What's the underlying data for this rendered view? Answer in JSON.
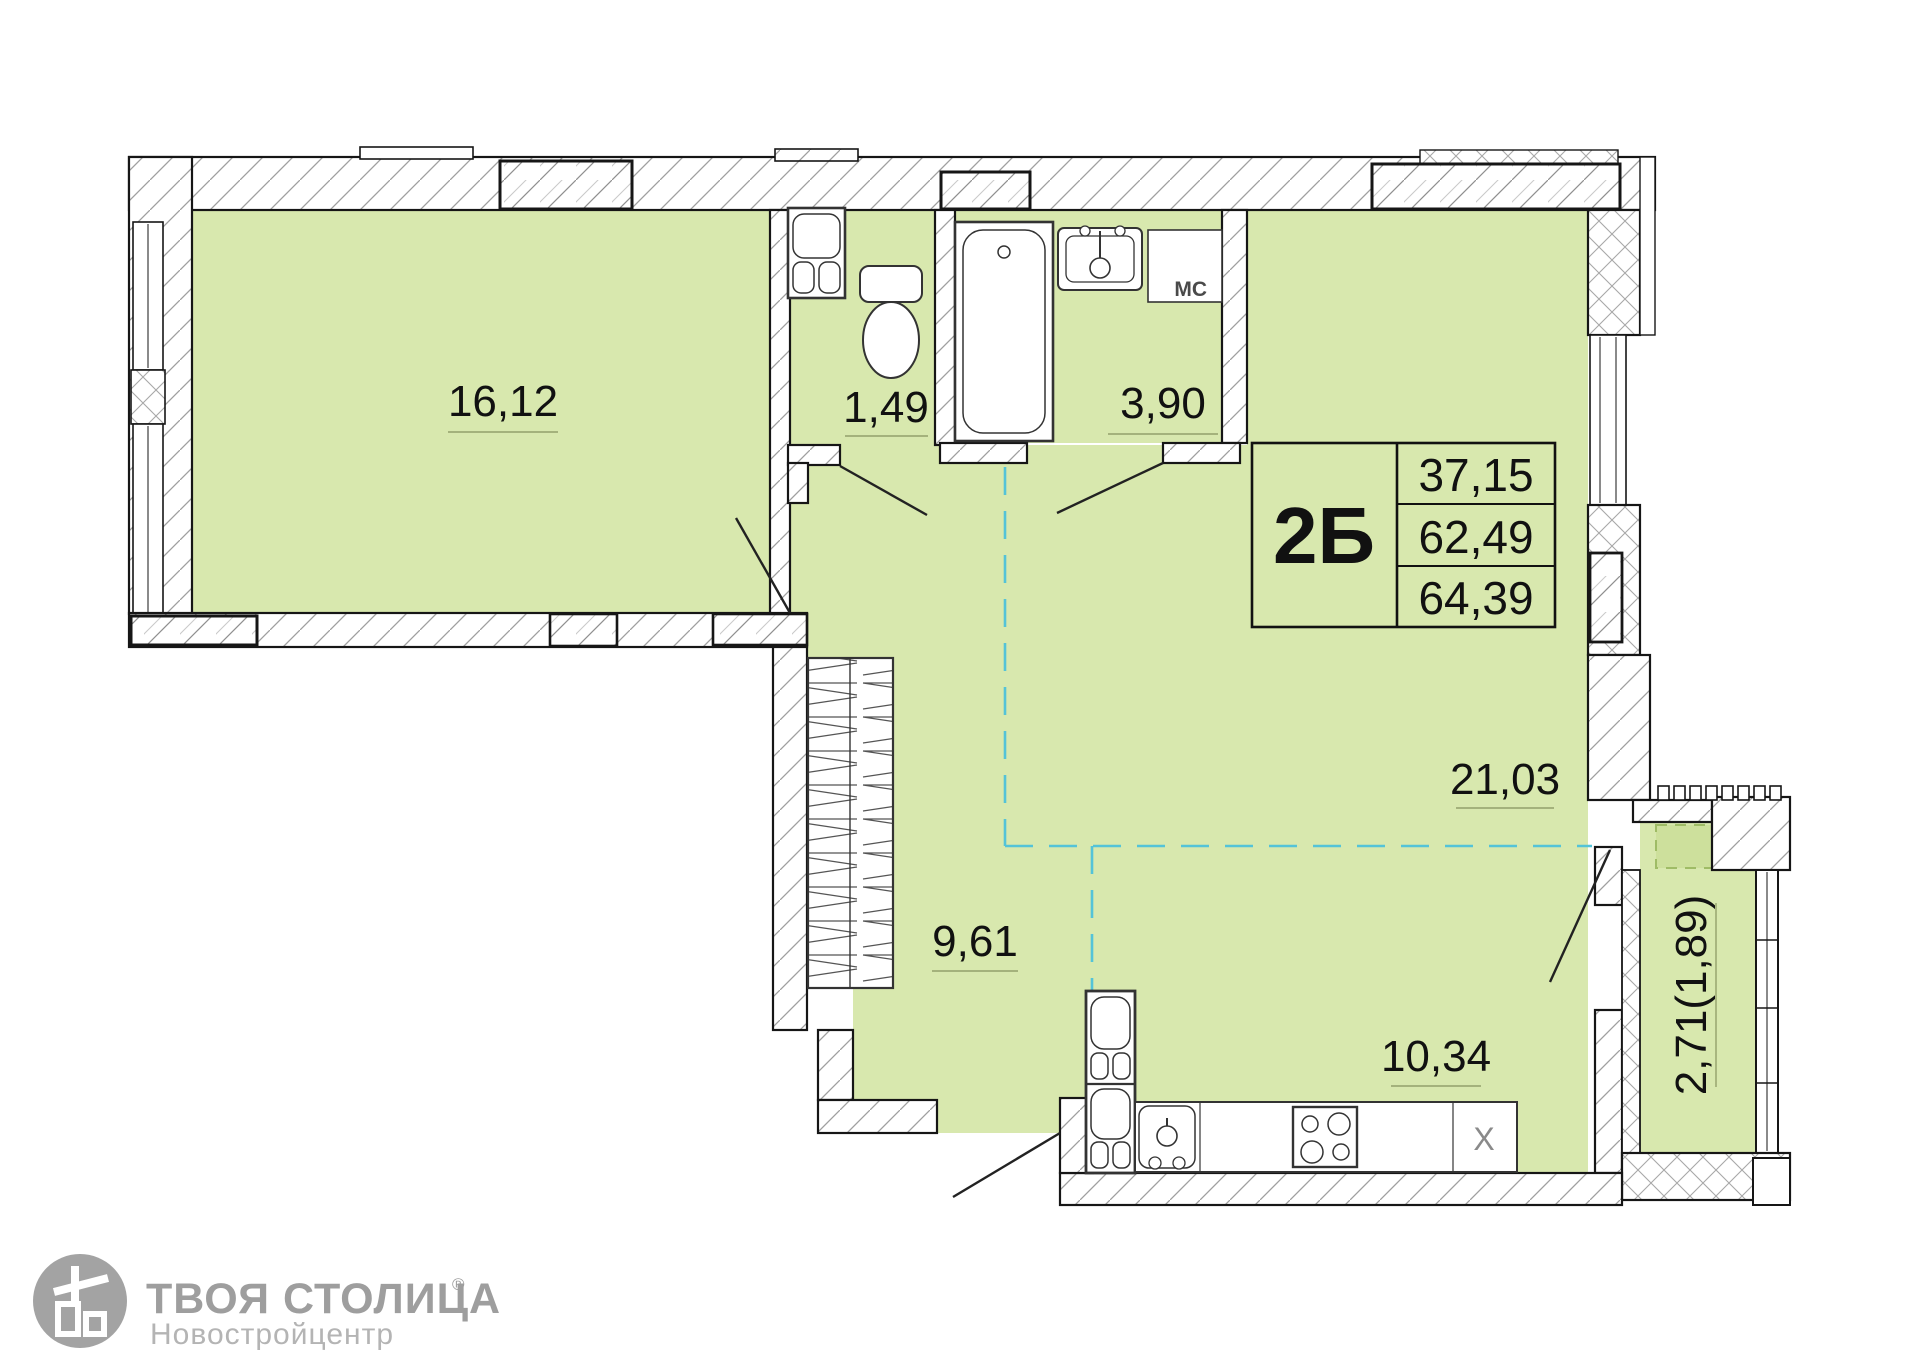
{
  "plan": {
    "unit": {
      "code": "2Б",
      "living_area": "37,15",
      "area_without_balcony": "62,49",
      "total_area": "64,39"
    },
    "rooms": {
      "living": "16,12",
      "wc": "1,49",
      "bathroom": "3,90",
      "main_room": "21,03",
      "hall": "9,61",
      "kitchen": "10,34",
      "balcony": "2,71(1,89)"
    },
    "marks": {
      "washing_machine_place": "МС",
      "kitchen_vent": "X"
    }
  },
  "branding": {
    "name": "ТВОЯ СТОЛИЦА",
    "reg_mark": "®",
    "subtitle": "Новостройцентр"
  },
  "colors": {
    "floor_green": "#d8e8ae",
    "floor_green_dark": "#cde09c",
    "dash_cyan": "#54c3d8",
    "underline_olive": "#93a06b",
    "logo_gray": "#9e9e9e"
  }
}
